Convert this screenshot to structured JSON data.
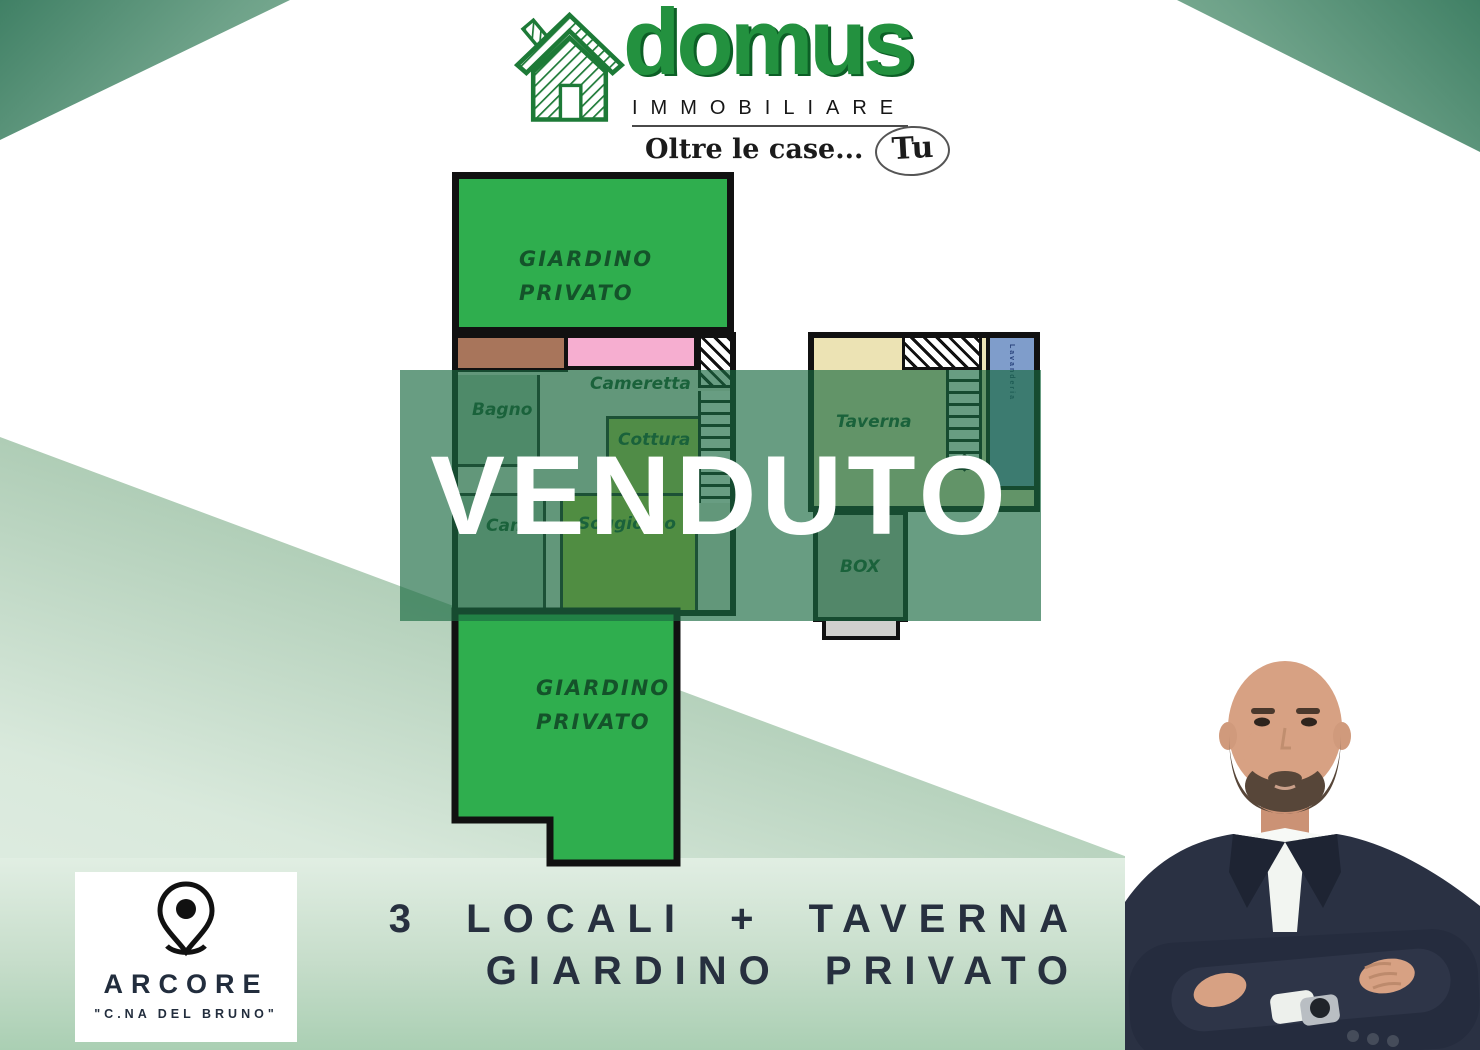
{
  "brand": {
    "name": "domus",
    "subtitle": "IMMOBILIARE",
    "tagline": "Oltre le case...",
    "tagline_highlight": "Tu"
  },
  "status_banner": {
    "label": "VENDUTO"
  },
  "floorplan": {
    "garden_top": {
      "line1": "GIARDINO",
      "line2": "PRIVATO"
    },
    "garden_bottom": {
      "line1": "GIARDINO",
      "line2": "PRIVATO"
    },
    "rooms": {
      "cameretta": "Cameretta",
      "bagno": "Bagno",
      "cottura": "Cottura",
      "camera": "Camera",
      "soggiorno": "Soggiorno",
      "taverna": "Taverna",
      "lavanderia": "Lavanderia",
      "box": "BOX"
    }
  },
  "location": {
    "city": "ARCORE",
    "district": "\"C.NA DEL BRUNO\""
  },
  "caption": {
    "line1": "3 LOCALI + TAVERNA",
    "line2": "GIARDINO PRIVATO"
  },
  "colors": {
    "brand_green": "#23913f",
    "garden_green": "#2fae4e",
    "banner_green": "#1a6b42",
    "navy_text": "#27303f"
  }
}
